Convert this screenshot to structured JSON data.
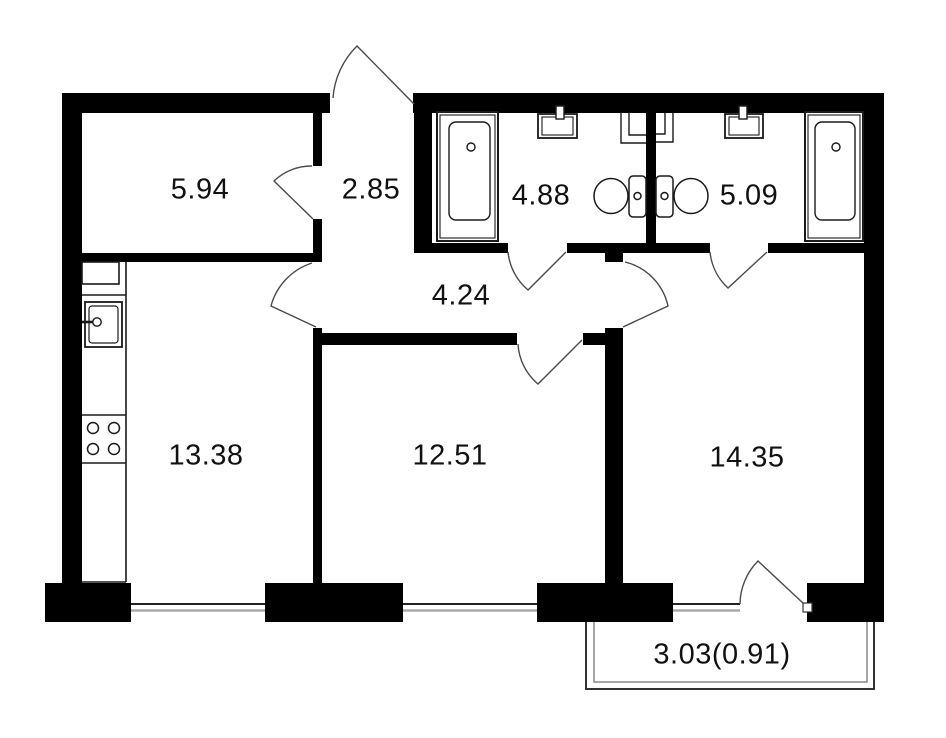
{
  "figure": {
    "kind": "apartment-floor-plan",
    "units": "square-meters-implied"
  },
  "rooms": [
    {
      "key": "room-top-left",
      "area": "5.94"
    },
    {
      "key": "entry-hall",
      "area": "2.85"
    },
    {
      "key": "bathroom-left",
      "area": "4.88"
    },
    {
      "key": "bathroom-right",
      "area": "5.09"
    },
    {
      "key": "hallway",
      "area": "4.24"
    },
    {
      "key": "kitchen",
      "area": "13.38"
    },
    {
      "key": "room-bottom-middle",
      "area": "12.51"
    },
    {
      "key": "room-bottom-right",
      "area": "14.35"
    },
    {
      "key": "balcony",
      "area": "3.03(0.91)"
    }
  ],
  "fixtures": [
    "bathtub-icon",
    "bathtub-icon",
    "wash-sink-icon",
    "wash-sink-icon",
    "toilet-icon",
    "toilet-icon",
    "vent-duct-icon",
    "vent-duct-icon",
    "kitchen-sink-icon",
    "stove-icon",
    "kitchen-counter"
  ],
  "colors": {
    "wall": "#000000",
    "background": "#ffffff",
    "fixture_line": "#1a1a1a",
    "door_arc": "#4a4a4a",
    "window_dark": "#222222",
    "window_light": "#aaaaaa",
    "label_text": "#111111"
  }
}
